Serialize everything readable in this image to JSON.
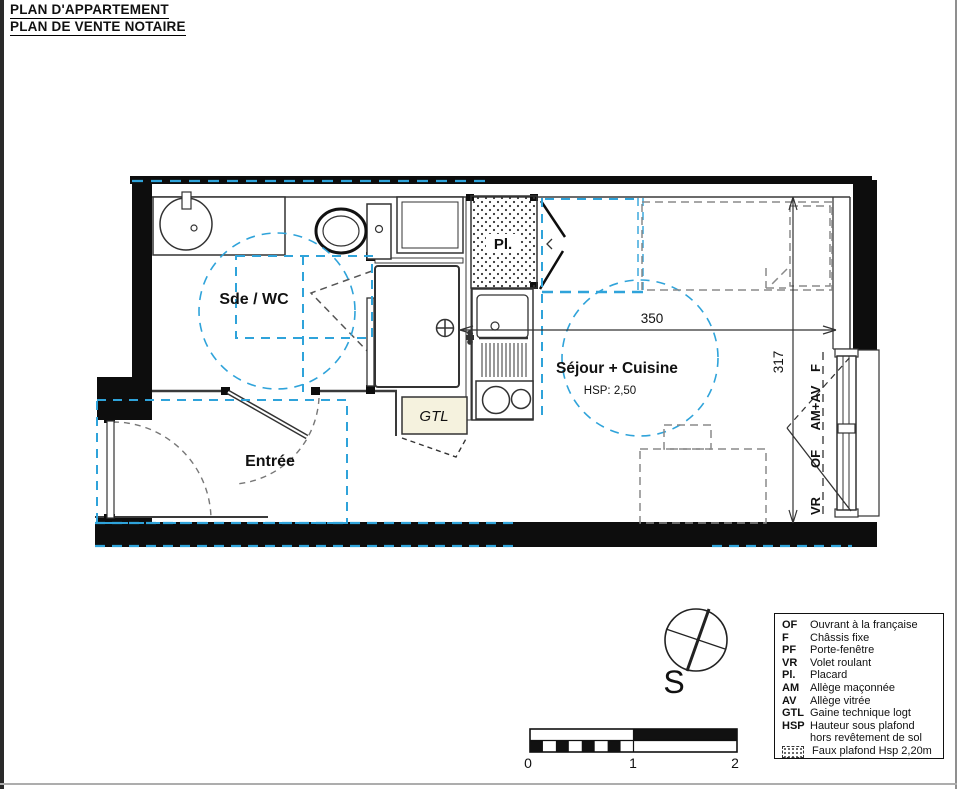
{
  "page": {
    "title_line1": "PLAN D'APPARTEMENT",
    "title_line2": "PLAN DE VENTE NOTAIRE"
  },
  "plan": {
    "room_labels": {
      "sde_wc": "Sde / WC",
      "entree": "Entrée",
      "sejour": "Séjour + Cuisine",
      "sejour_hsp": "HSP: 2,50",
      "closet": "Pl.",
      "gtl": "GTL"
    },
    "dimensions": {
      "width_cm": "350",
      "height_cm": "317"
    },
    "window_labels": {
      "f": "F",
      "am_av": "AM+AV",
      "of": "OF",
      "vr": "VR"
    },
    "compass": {
      "south": "S"
    }
  },
  "scale_bar": {
    "tick_0": "0",
    "tick_1": "1",
    "tick_2": "2"
  },
  "legend": {
    "items": [
      {
        "abbr": "OF",
        "label": "Ouvrant à la française"
      },
      {
        "abbr": "F",
        "label": "Châssis fixe"
      },
      {
        "abbr": "PF",
        "label": "Porte-fenêtre"
      },
      {
        "abbr": "VR",
        "label": "Volet roulant"
      },
      {
        "abbr": "Pl.",
        "label": "Placard"
      },
      {
        "abbr": "AM",
        "label": "Allège maçonnée"
      },
      {
        "abbr": "AV",
        "label": "Allège vitrée"
      },
      {
        "abbr": "GTL",
        "label": "Gaine technique logt"
      },
      {
        "abbr": "HSP",
        "label": "Hauteur sous plafond hors revêtement de sol"
      },
      {
        "abbr": "",
        "label": "Faux plafond Hsp 2,20m"
      }
    ]
  },
  "colors": {
    "faux_plafond_dash": "#2FA3DA",
    "wall": "#0D0D0D",
    "gtl_fill": "#F5F2DE",
    "furniture_dash": "#8A8A8A"
  }
}
